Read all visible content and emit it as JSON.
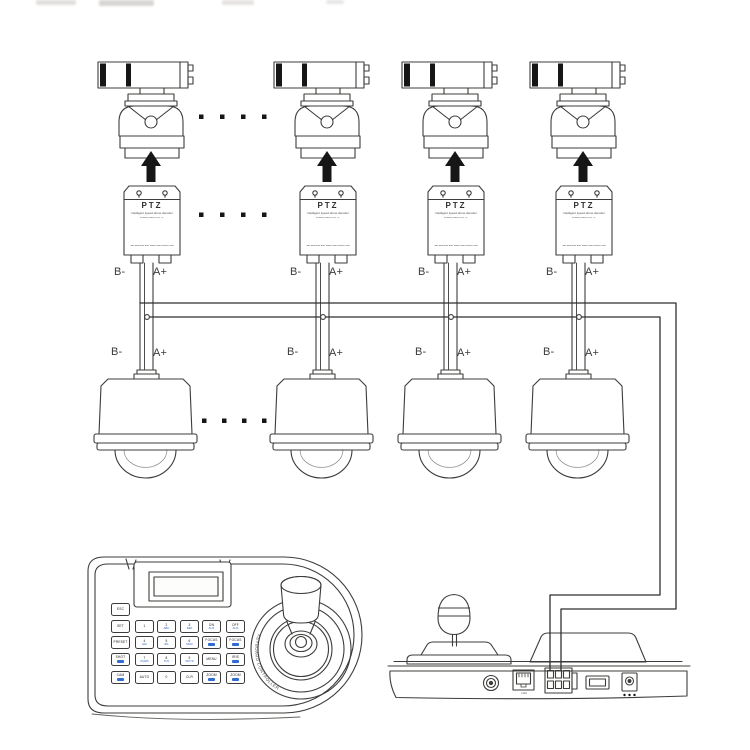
{
  "labels": {
    "b_minus": "B-",
    "a_plus": "A+"
  },
  "ptz_decoder": {
    "title": "PTZ",
    "line1": "Intelligent speed dome decoder",
    "line2": "RS485 PELCO-D / P",
    "bottom_line": "Set address and baud rate before use"
  },
  "ellipsis": {
    "groups": 3,
    "dots_per_group": 4
  },
  "keyboard": {
    "esc": {
      "m": "ESC",
      "s": ""
    },
    "keys": [
      [
        {
          "m": "SET",
          "s": ""
        },
        {
          "m": "1",
          "s": ""
        },
        {
          "m": "2",
          "s": "ABC"
        },
        {
          "m": "3",
          "s": "DEF"
        },
        {
          "m": "ON",
          "s": "AUX"
        },
        {
          "m": "OFF",
          "s": "AUX"
        }
      ],
      [
        {
          "m": "PRESET",
          "s": ""
        },
        {
          "m": "4",
          "s": "GHI"
        },
        {
          "m": "5",
          "s": "JKL"
        },
        {
          "m": "6",
          "s": "MNO"
        },
        {
          "m": "FOCUS",
          "s": ""
        },
        {
          "m": "FOCUS",
          "s": ""
        }
      ],
      [
        {
          "m": "SHOT",
          "s": ""
        },
        {
          "m": "7",
          "s": "PQRS"
        },
        {
          "m": "8",
          "s": "TUV"
        },
        {
          "m": "9",
          "s": "WXYZ"
        },
        {
          "m": "MENU",
          "s": ""
        },
        {
          "m": "IRIS",
          "s": ""
        }
      ],
      [
        {
          "m": "CAM",
          "s": ""
        },
        {
          "m": "AUTO",
          "s": ""
        },
        {
          "m": "0",
          "s": ""
        },
        {
          "m": "CLR",
          "s": ""
        },
        {
          "m": "ZOOM",
          "s": ""
        },
        {
          "m": "ZOOM",
          "s": ""
        }
      ]
    ],
    "joystick_text": "KEYBOARD CONTROLLER",
    "key_accent": "#2f6bd0"
  },
  "rear_panel": {
    "lan_label": "LAN"
  },
  "colors": {
    "ink": "#3d3c3a",
    "wire": "#2f2f2f",
    "black": "#161616",
    "key_sub": "#2b62c9"
  }
}
